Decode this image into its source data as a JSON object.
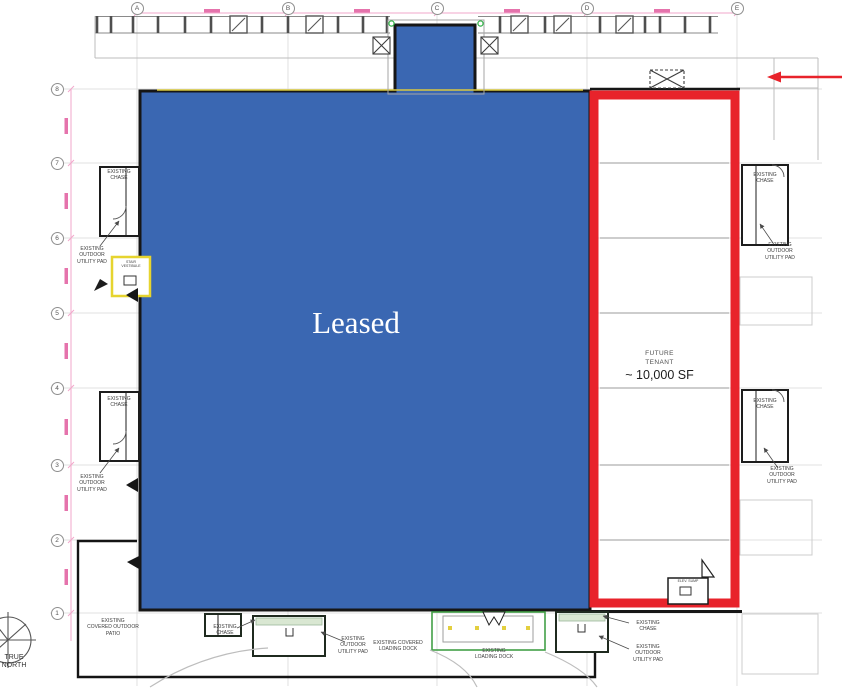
{
  "drawing": {
    "grid": {
      "columns": [
        "A",
        "B",
        "C",
        "D",
        "E"
      ],
      "rows": [
        "8",
        "7",
        "6",
        "5",
        "4",
        "3",
        "2",
        "1"
      ]
    },
    "areas": {
      "leased": {
        "label": "Leased"
      },
      "future_tenant": {
        "name": "FUTURE\nTENANT",
        "size": "~ 10,000 SF"
      }
    },
    "annotations": {
      "existing_chase": "EXISTING\nCHASE",
      "existing_outdoor_utility_pad": "EXISTING\nOUTDOOR\nUTILITY PAD",
      "existing_covered_outdoor_patio": "EXISTING\nCOVERED OUTDOOR\nPATIO",
      "existing_covered_loading_dock": "EXISTING COVERED\nLOADING DOCK",
      "existing_loading_dock": "EXISTING\nLOADING DOCK",
      "stair_vestibule": "STAIR\nVESTIBULE",
      "elev_sump": "ELEV. SUMP",
      "true_north": "TRUE\nNORTH"
    },
    "colors": {
      "leased_blue": "#3a67b2",
      "highlight_red": "#e8232b",
      "dimension_pink": "#f2a7cb",
      "dimension_pink_dark": "#e05a9e",
      "vestibule_yellow": "#e6d42f",
      "dock_green": "#43a047",
      "pad_tint": "#d9e7d2"
    }
  }
}
